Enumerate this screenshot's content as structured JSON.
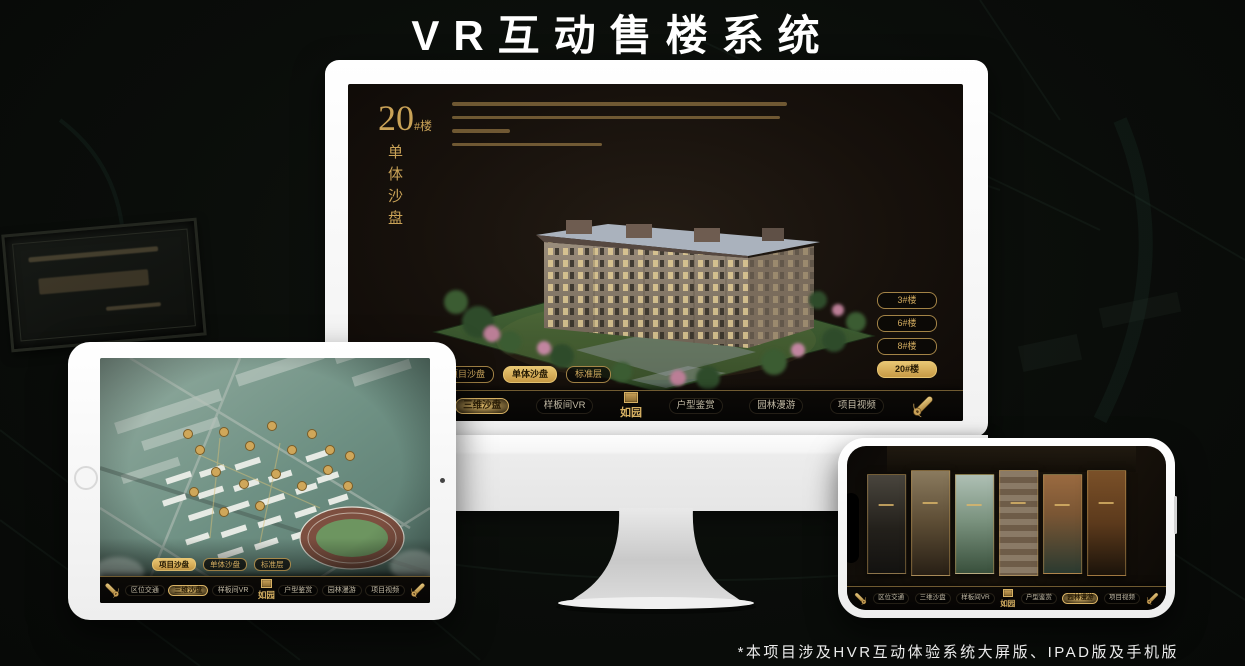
{
  "page": {
    "title": "VR互动售楼系统",
    "footnote": "*本项目涉及HVR互动体验系统大屏版、IPAD版及手机版"
  },
  "colors": {
    "accent_gold": "#c9a257",
    "active_button_gold": "#d9b05f"
  },
  "shared": {
    "logo": "如园",
    "tabs": [
      "项目沙盘",
      "单体沙盘",
      "标准层"
    ],
    "nav_items": [
      "区位交通",
      "三维沙盘",
      "样板间VR",
      "户型鉴赏",
      "园林漫游",
      "项目视频"
    ]
  },
  "monitor": {
    "headline": {
      "number": "20",
      "suffix": "#楼",
      "subtitle": "单体沙盘"
    },
    "floor_buttons": [
      "3#楼",
      "6#楼",
      "8#楼",
      "20#楼"
    ],
    "active_floor": "20#楼",
    "active_tab": "单体沙盘",
    "active_nav": "三维沙盘"
  },
  "tablet": {
    "active_tab": "项目沙盘",
    "active_nav": "三维沙盘"
  },
  "phone": {
    "active_nav": "园林漫游"
  }
}
